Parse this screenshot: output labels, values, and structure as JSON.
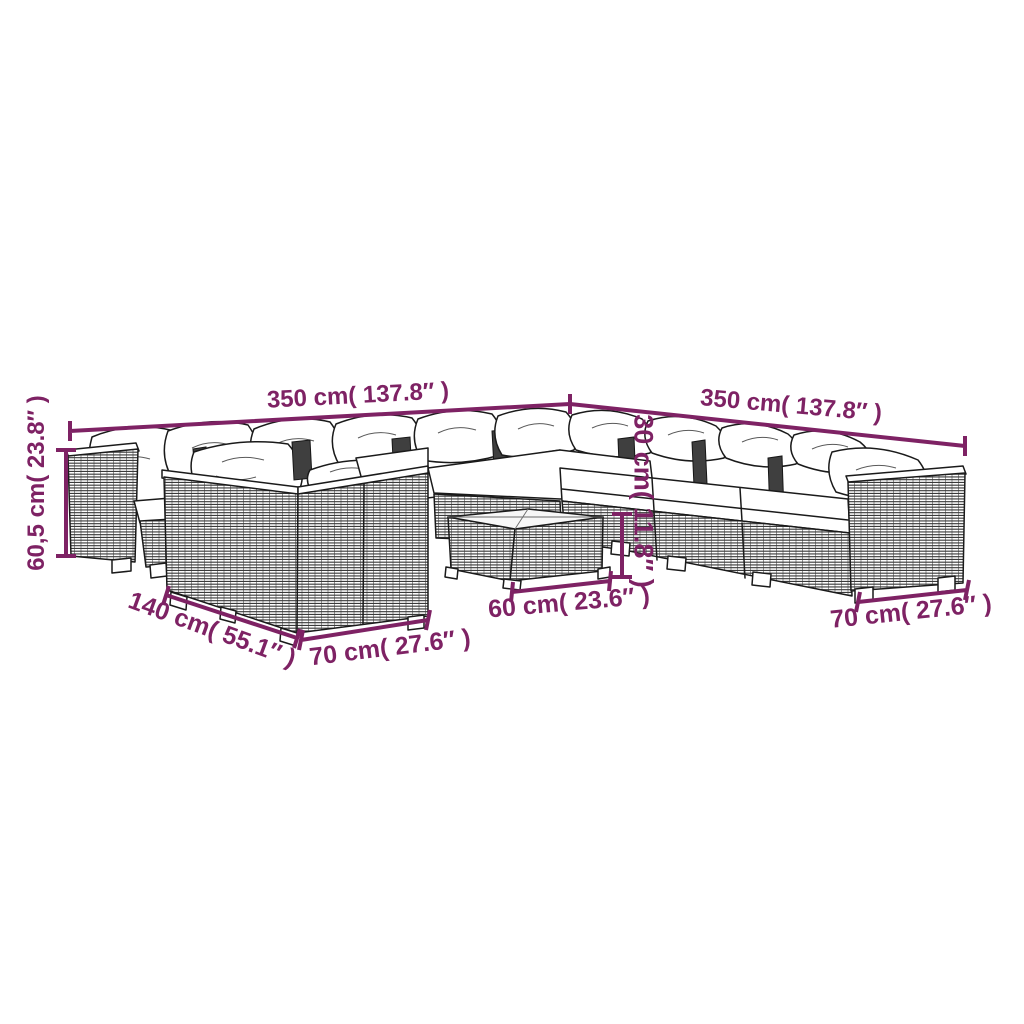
{
  "diagram": {
    "background": "#ffffff",
    "accent_color": "#7E2264",
    "line_color": "#1a1a1a"
  },
  "dimensions": {
    "top_left_width": "350 cm( 137.8″ )",
    "top_right_width": "350 cm( 137.8″ )",
    "left_height": "60,5 cm( 23.8″ )",
    "back_height": "30 cm( 11.8″ )",
    "sofa_depth": "140 cm( 55.1″ )",
    "sofa_front_width": "70 cm( 27.6″ )",
    "table_width": "60 cm( 23.6″ )",
    "right_module_width": "70 cm( 27.6″ )"
  }
}
